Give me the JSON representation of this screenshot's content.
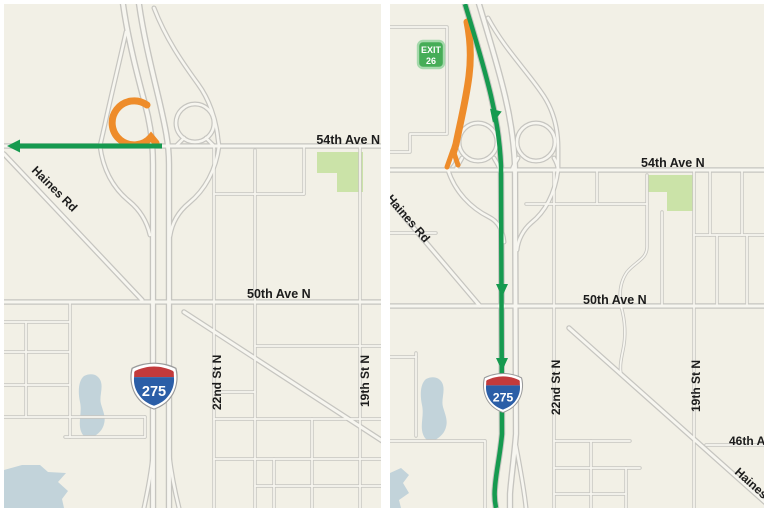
{
  "page": {
    "background": "#ffffff",
    "panel_background": "#F2F0E6"
  },
  "colors": {
    "road_casing": "#C6C5C0",
    "road_fill": "#F7F6F0",
    "route_green": "#169A4F",
    "ramp_orange": "#EE8C2A",
    "park_green": "#CBE3A8",
    "water_blue": "#C2D3DA",
    "label_black": "#1C1C1C",
    "shield_red": "#C23A3C",
    "shield_blue": "#2B5EA7",
    "exit_sign_green": "#46AD57",
    "exit_sign_border": "#A6D9AC"
  },
  "left_map": {
    "labels": {
      "ave_54": "54th Ave N",
      "haines_rd": "Haines Rd",
      "ave_50": "50th Ave N",
      "st_22": "22nd St N",
      "st_19": "19th St N"
    },
    "shield_number": "275"
  },
  "right_map": {
    "exit_sign": {
      "line1": "EXIT",
      "line2": "26"
    },
    "labels": {
      "ave_54": "54th Ave N",
      "haines_rd_nw": "Haines Rd",
      "ave_50": "50th Ave N",
      "st_22": "22nd St N",
      "st_19": "19th St N",
      "ave_46": "46th Ave N",
      "haines_rd_se": "Haines Rd"
    },
    "shield_number": "275"
  }
}
